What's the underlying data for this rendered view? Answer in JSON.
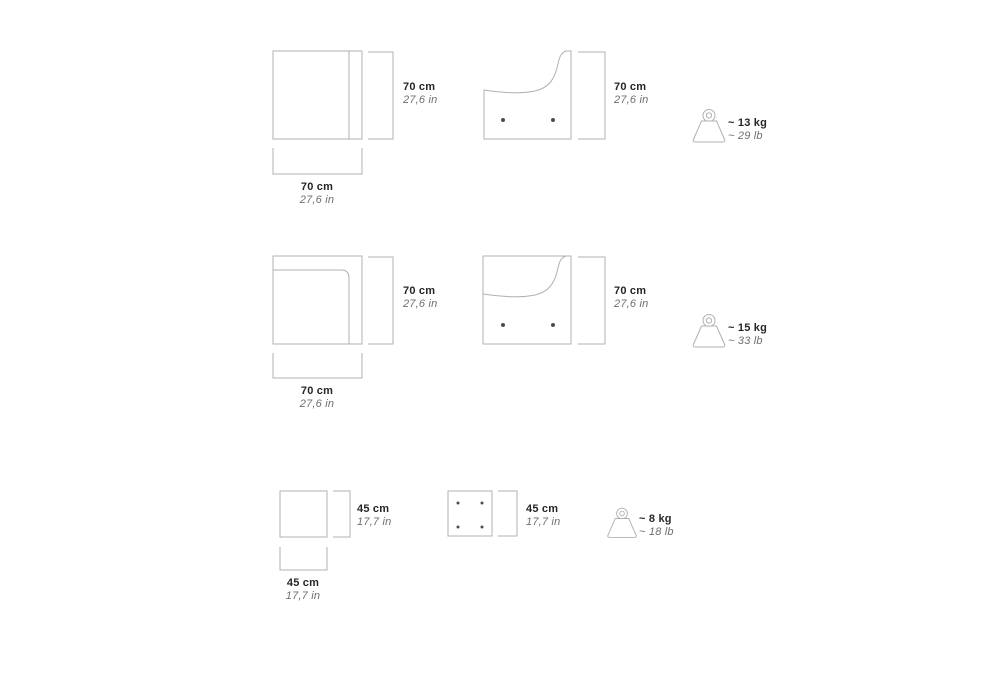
{
  "canvas": {
    "background": "#ffffff",
    "line_color": "#b0b0b0",
    "dot_color": "#4d4d4d",
    "primary_text_color": "#262626",
    "secondary_text_color": "#6e6e6e"
  },
  "rows": [
    {
      "id": "seat-module-70",
      "front": {
        "height_metric": "70 cm",
        "height_imperial": "27,6 in",
        "width_metric": "70 cm",
        "width_imperial": "27,6 in"
      },
      "side": {
        "height_metric": "70 cm",
        "height_imperial": "27,6 in"
      },
      "weight": {
        "icon": "weight-icon",
        "metric": "~ 13 kg",
        "imperial": "~ 29 lb"
      }
    },
    {
      "id": "corner-module-70",
      "front": {
        "height_metric": "70 cm",
        "height_imperial": "27,6 in",
        "width_metric": "70 cm",
        "width_imperial": "27,6 in"
      },
      "side": {
        "height_metric": "70 cm",
        "height_imperial": "27,6 in"
      },
      "weight": {
        "icon": "weight-icon",
        "metric": "~ 15 kg",
        "imperial": "~ 33 lb"
      }
    },
    {
      "id": "pouf-45",
      "front": {
        "height_metric": "45 cm",
        "height_imperial": "17,7 in",
        "width_metric": "45 cm",
        "width_imperial": "17,7 in"
      },
      "top": {
        "height_metric": "45 cm",
        "height_imperial": "17,7 in"
      },
      "weight": {
        "icon": "weight-icon",
        "metric": "~ 8 kg",
        "imperial": "~ 18 lb"
      }
    }
  ]
}
